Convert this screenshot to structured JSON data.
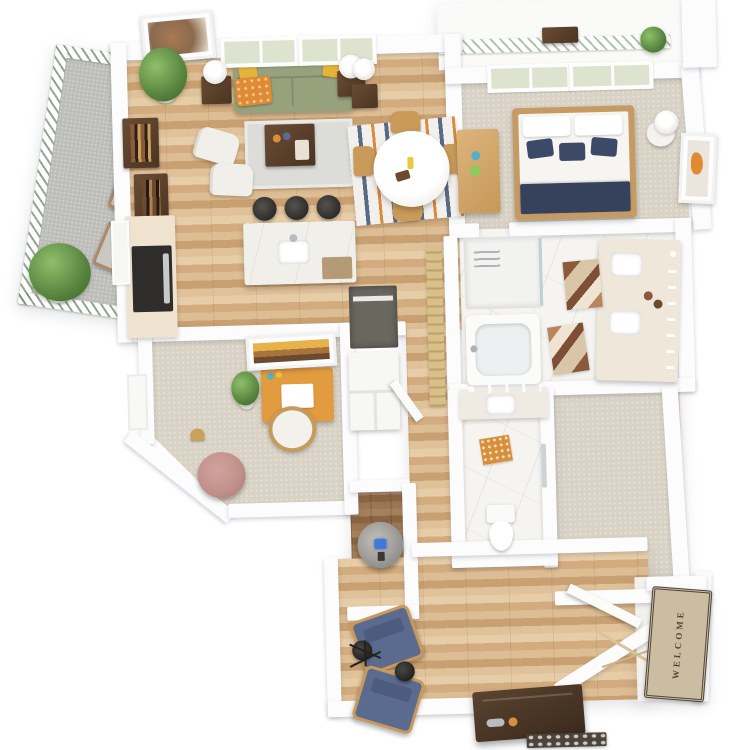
{
  "scene": {
    "type": "3d-floor-plan-top-down-render",
    "background": "#ffffff",
    "unit": "one-bedroom apartment with den"
  },
  "entry": {
    "welcome_mat": {
      "text": "WELCOME",
      "mat_color": "#cbbda1",
      "border_color": "#4e4439"
    }
  },
  "palette": {
    "wall": "#fcfcfd",
    "hardwood": "#d6b288",
    "hardwood_dark": "#96714f",
    "carpet": "#d9d3c6",
    "marble_tile": "#f5f4f1",
    "concrete": "#bdbdb9",
    "sofa_sage": "#97a27c",
    "pillow_yellow": "#e3b33a",
    "throw_orange": "#e08a33",
    "bed_navy": "#3c4a68",
    "denim_chair": "#5b6b90",
    "pouf_pink": "#c08f8a",
    "desk_orange": "#e29b3f",
    "walnut": "#5a4534",
    "stool_black": "#3b3937",
    "chair_wood": "#c99a5a",
    "washer_display_blue": "#4577d6",
    "rug_orange": "#d78f3c",
    "plant_green": "#54803c",
    "window_glass": "#dde3cf"
  },
  "rooms": [
    {
      "name": "balcony",
      "floor": "concrete"
    },
    {
      "name": "living-area",
      "floor": "hardwood"
    },
    {
      "name": "kitchen",
      "floor": "hardwood"
    },
    {
      "name": "dining-nook",
      "floor": "hardwood"
    },
    {
      "name": "bedroom",
      "floor": "carpet"
    },
    {
      "name": "bedroom-balcony",
      "floor": "deck"
    },
    {
      "name": "bathroom",
      "floor": "marble-tile"
    },
    {
      "name": "walk-in-closet",
      "floor": "carpet"
    },
    {
      "name": "powder-room",
      "floor": "marble-tile"
    },
    {
      "name": "den-office",
      "floor": "carpet"
    },
    {
      "name": "laundry-closet",
      "floor": "hardwood-dark"
    },
    {
      "name": "flex-sitting-area",
      "floor": "hardwood"
    },
    {
      "name": "entry",
      "floor": "hardwood"
    }
  ],
  "furniture": {
    "living": [
      "sage sofa with yellow pillows and orange throw",
      "two end tables with white lamps",
      "walnut coffee table on gray rug",
      "two white accent chairs",
      "wall art",
      "tall plant",
      "walnut wall shelves"
    ],
    "kitchen": [
      "cream counter with black range",
      "white quartz island with sink",
      "three black bar stools"
    ],
    "dining": [
      "round white pedestal table",
      "four wood chairs",
      "striped rug"
    ],
    "bedroom": [
      "wood bed with white and navy bedding",
      "dresser",
      "nightstand with lamp",
      "wall art"
    ],
    "bathroom": [
      "glass shower",
      "soaking tub",
      "double vanity with sconces",
      "two geometric rugs"
    ],
    "powder": [
      "vanity sink",
      "toilet",
      "orange rug",
      "towel bar"
    ],
    "den": [
      "orange desk with laptop",
      "desk chair",
      "plant",
      "pink pouf",
      "floor lamp",
      "wall art",
      "closet shelves"
    ],
    "laundry": [
      "washer with blue display"
    ],
    "flex": [
      "two denim armchairs",
      "two black side tables",
      "black tripod floor lamp"
    ],
    "entry": [
      "welcome mat",
      "open door",
      "console bench",
      "pebble shoe tray",
      "decor branch"
    ],
    "balcony": [
      "two outdoor chairs",
      "potted plants",
      "white railing"
    ]
  }
}
